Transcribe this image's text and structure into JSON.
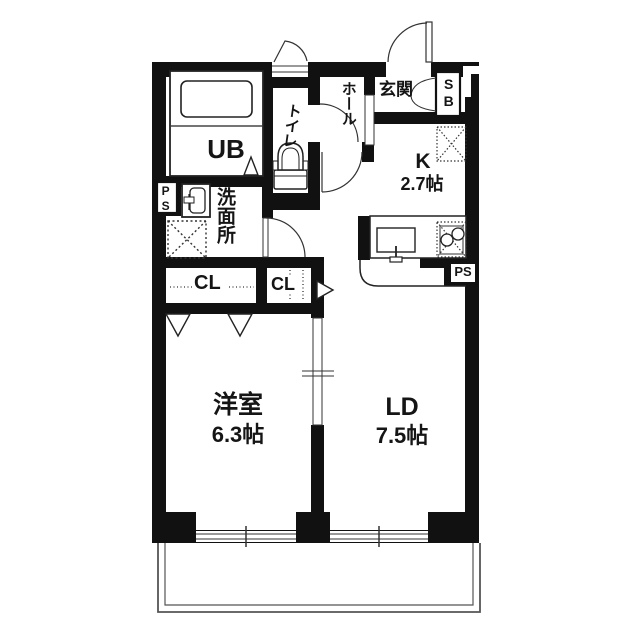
{
  "floorplan": {
    "rooms": {
      "unit_bath": {
        "label": "UB"
      },
      "toilet": {
        "label": "トイレ"
      },
      "hall": {
        "label": "ホール"
      },
      "entrance": {
        "label": "玄関"
      },
      "shoe_box": {
        "label": "SB"
      },
      "kitchen": {
        "label": "K",
        "size": "2.7帖"
      },
      "washroom": {
        "label": "洗面所"
      },
      "pipe_space_top": {
        "label": "PS"
      },
      "pipe_space_bottom": {
        "label": "PS"
      },
      "closet_main": {
        "label": "CL"
      },
      "closet_side": {
        "label": "CL"
      },
      "western_room": {
        "label": "洋室",
        "size": "6.3帖"
      },
      "living_dining": {
        "label": "LD",
        "size": "7.5帖"
      }
    },
    "colors": {
      "wall": "#111111",
      "line": "#333333",
      "background": "#ffffff"
    }
  }
}
